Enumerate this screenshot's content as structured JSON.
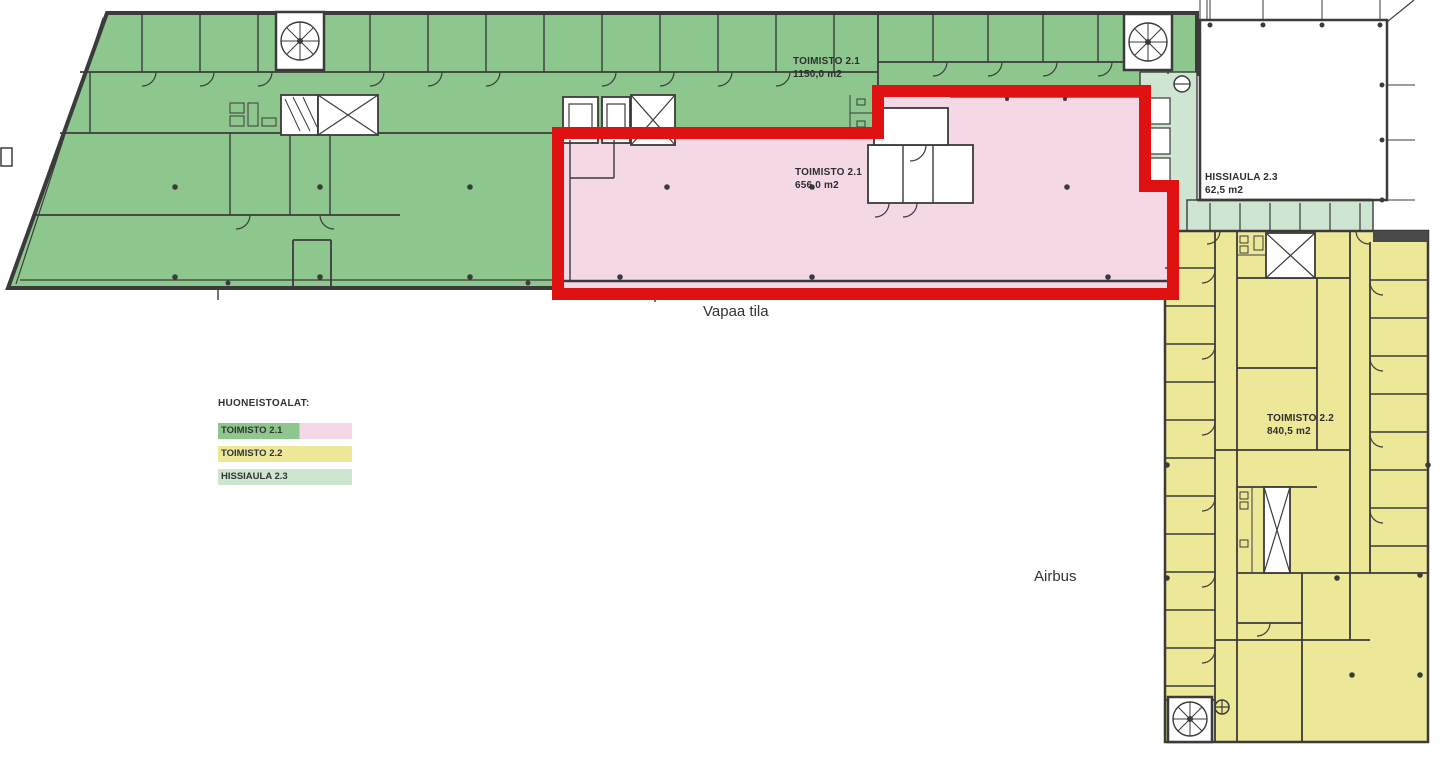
{
  "plan": {
    "areas": {
      "toimisto_21_main": {
        "name": "TOIMISTO 2.1",
        "area": "1150,0 m2"
      },
      "toimisto_21_free": {
        "name": "TOIMISTO 2.1",
        "area": "656,0 m2"
      },
      "hissiaula_23": {
        "name": "HISSIAULA 2.3",
        "area": "62,5 m2"
      },
      "toimisto_22": {
        "name": "TOIMISTO 2.2",
        "area": "840,5 m2"
      }
    },
    "annotations": {
      "free_space": "Vapaa tila",
      "neighbor": "Airbus"
    }
  },
  "legend": {
    "title": "HUONEISTOALAT:",
    "items": [
      {
        "label": "TOIMISTO 2.1"
      },
      {
        "label": "TOIMISTO 2.2"
      },
      {
        "label": "HISSIAULA 2.3"
      }
    ]
  },
  "colors": {
    "green": "#8dc78e",
    "pink": "#f4d8e5",
    "yellow": "#ede897",
    "ltgreen": "#cde5d1",
    "red": "#e01111",
    "wall": "#3b3b3b"
  }
}
